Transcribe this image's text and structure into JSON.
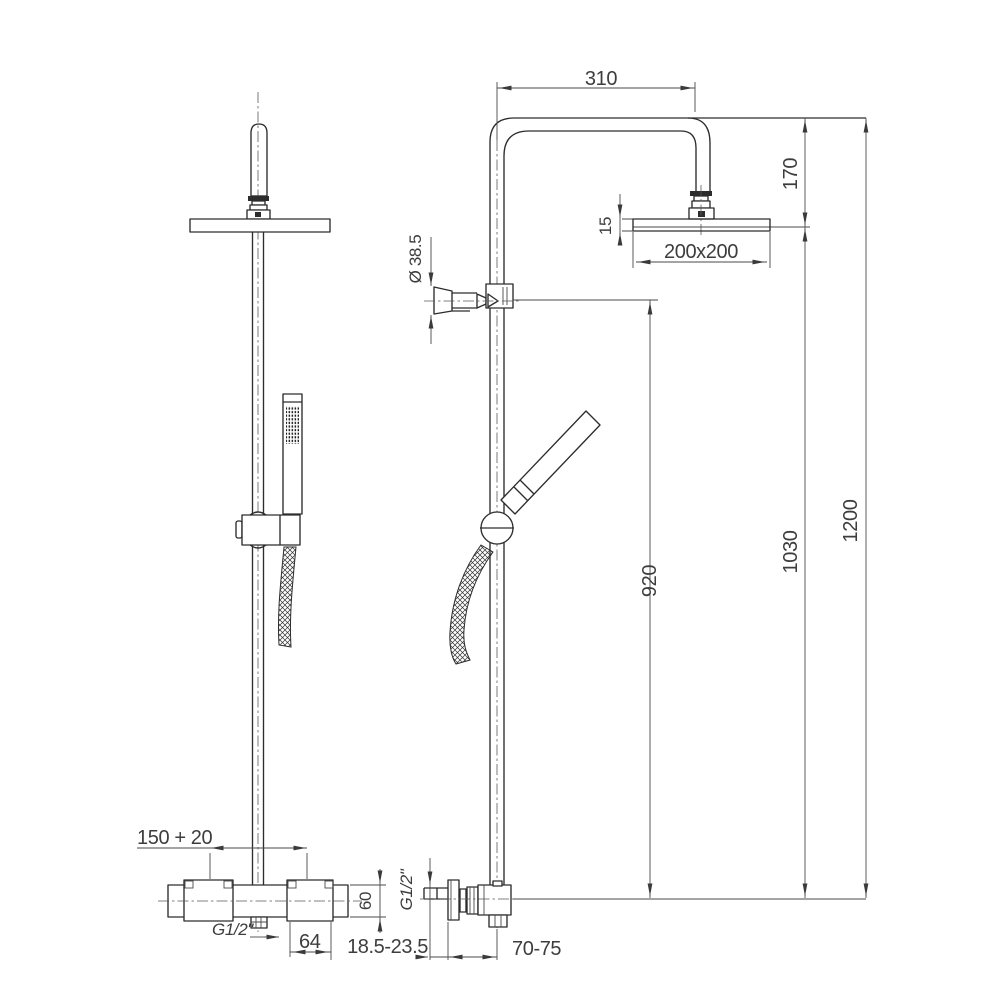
{
  "canvas": {
    "background": "#ffffff",
    "object_line_color": "#2d2d2d",
    "thin_line_color": "#4a4a4a",
    "text_color": "#3d3d3d"
  },
  "drawing": {
    "type": "technical dimension drawing",
    "subject": "shower column with overhead rain shower, hand shower and thermostatic mixer - front and side views",
    "dimensions": {
      "arm_width": "310",
      "head_drop": "170",
      "head_thickness": "15",
      "head_size": "200x200",
      "bracket_diameter": "Ø 38.5",
      "rail_height": "920",
      "head_center_height": "1030",
      "total_height": "1200",
      "valve_centers": "150 + 20",
      "outlet_thread": "G1/2\"",
      "valve_block_width": "64",
      "valve_body_height": "60",
      "inlet_thread": "G1/2\"",
      "wall_clearance": "18.5-23.5",
      "wall_to_axis": "70-75"
    }
  }
}
